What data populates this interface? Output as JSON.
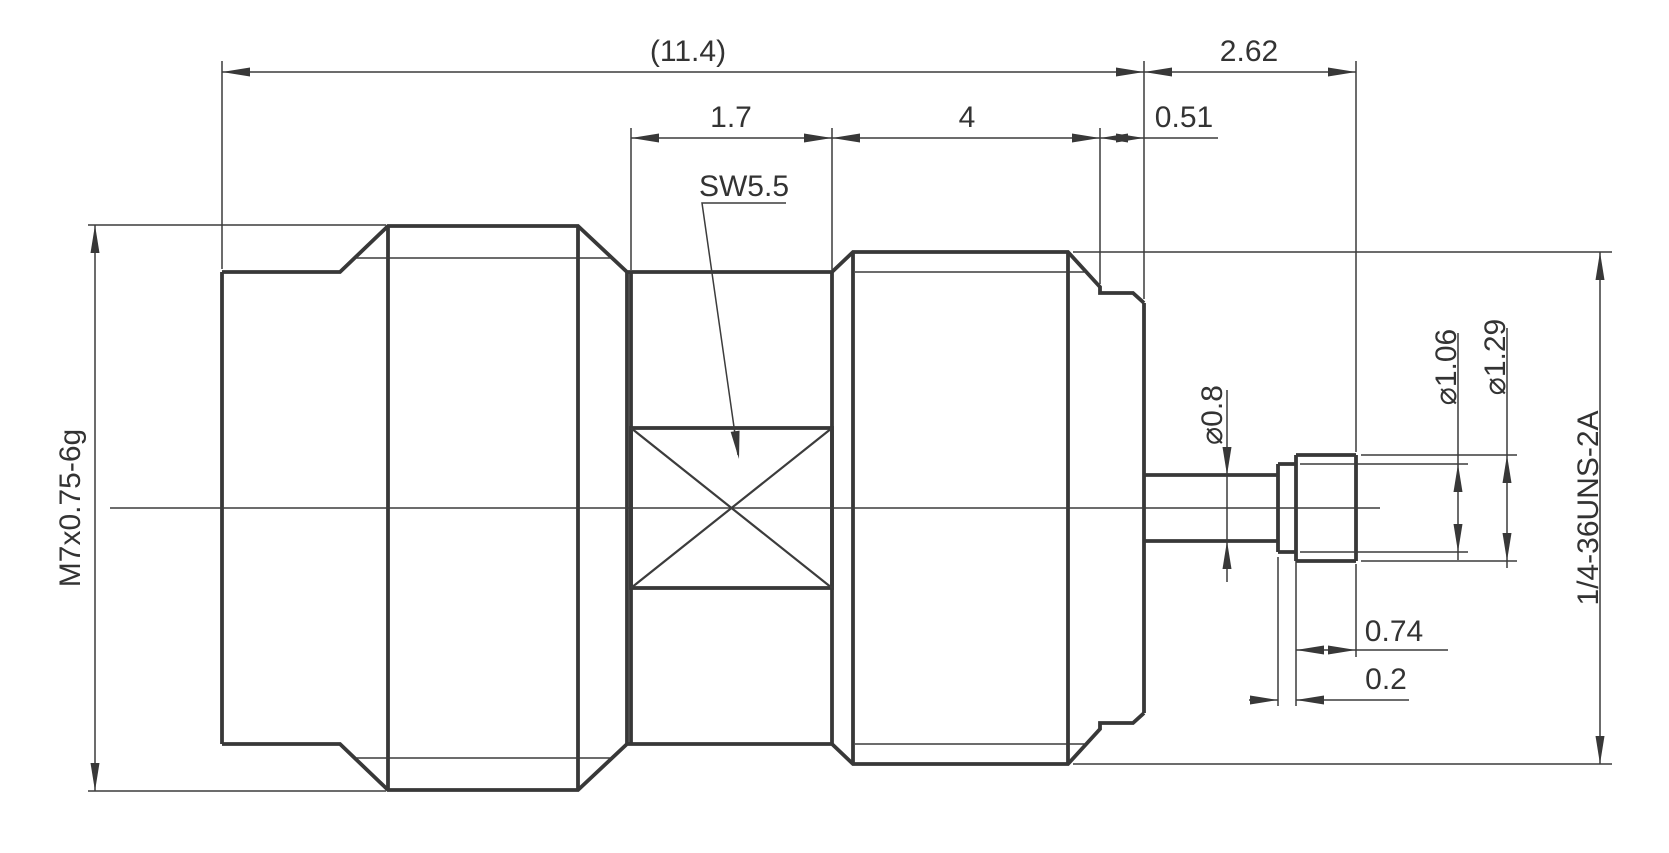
{
  "labels": {
    "overall_length": "(11.4)",
    "pin_protrusion_length": "2.62",
    "flat_section_length": "1.7",
    "thread_section_length": "4",
    "washer_thickness": "0.51",
    "wrench_size": "SW5.5",
    "left_thread_spec": "M7x0.75-6g",
    "pin_diameter": "⌀0.8",
    "pin_ring_diameter": "⌀1.06",
    "pin_tip_diameter": "⌀1.29",
    "right_thread_spec": "1/4-36UNS-2A",
    "pin_tip_length": "0.74",
    "pin_ring_length": "0.2"
  },
  "colors": {
    "line": "#383838",
    "text": "#333333",
    "background": "#ffffff"
  }
}
